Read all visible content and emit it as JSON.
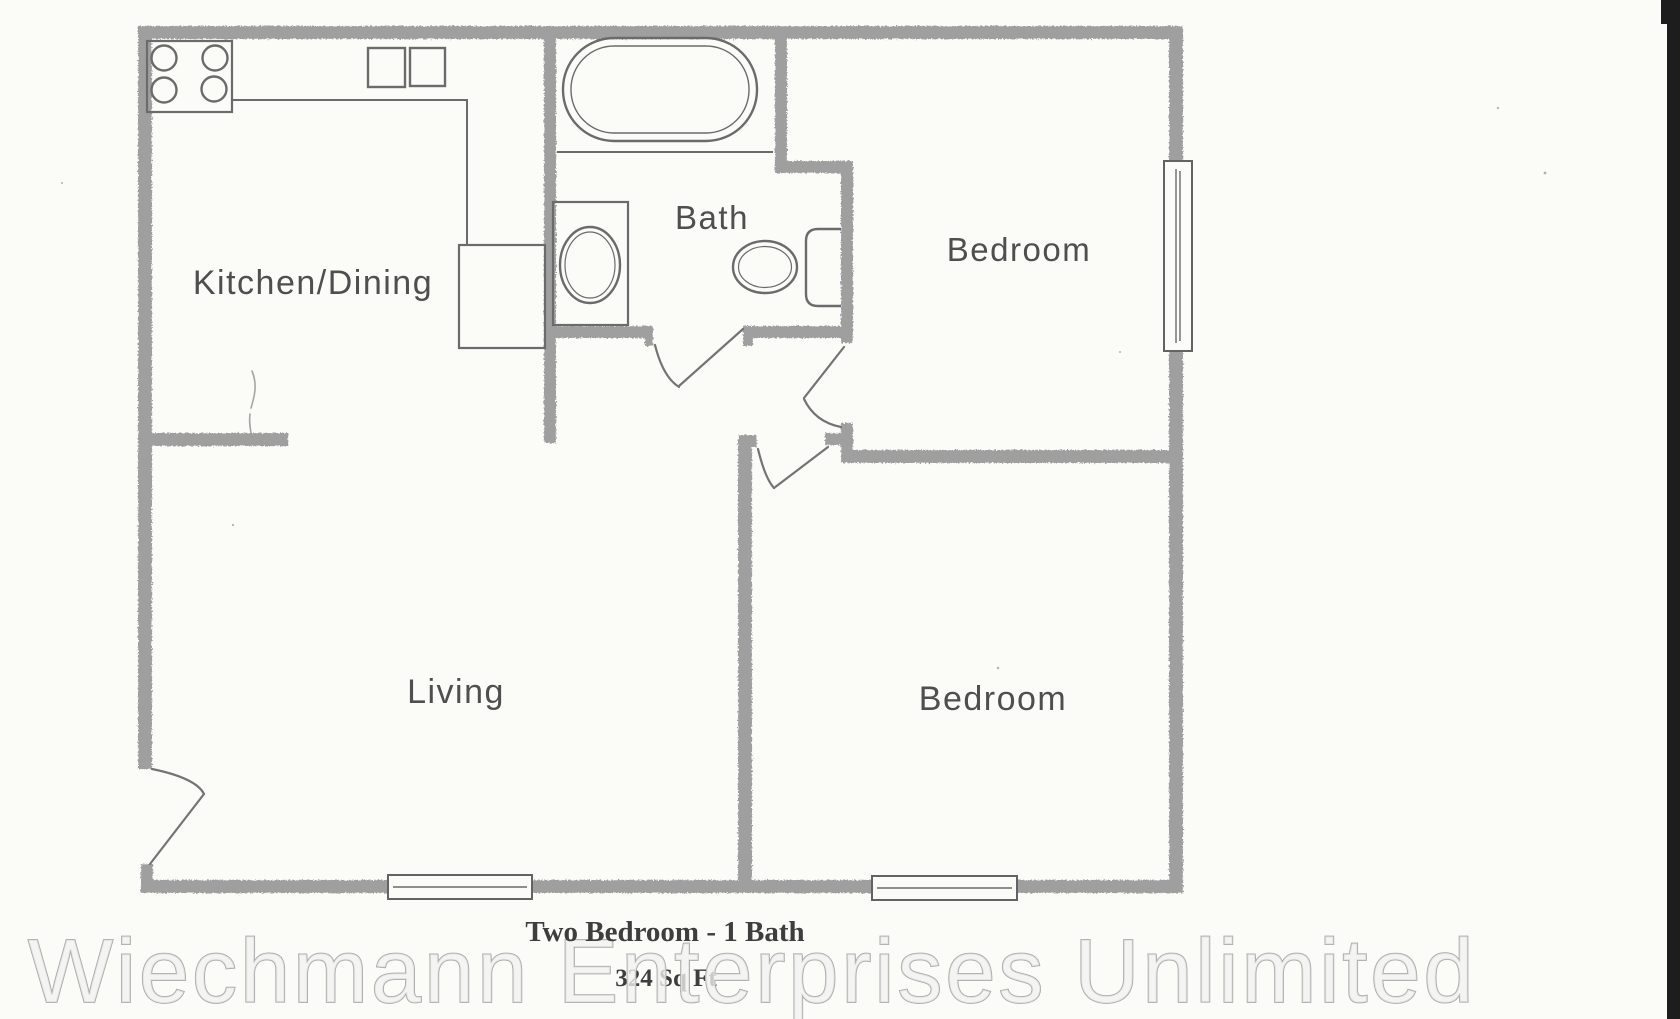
{
  "page": {
    "background": "#fbfbf8",
    "scan_edge_color": "#1d1d1d"
  },
  "colors": {
    "wall": "#9f9f9f",
    "fixture_line": "#6b6b6b",
    "label": "#4f4f4f",
    "caption": "#3e3e3e",
    "watermark_fill": "#f2f2ef"
  },
  "rooms": {
    "kitchen": {
      "label": "Kitchen/Dining"
    },
    "bath": {
      "label": "Bath"
    },
    "bedroom_top": {
      "label": "Bedroom"
    },
    "bedroom_bottom": {
      "label": "Bedroom"
    },
    "living": {
      "label": "Living"
    }
  },
  "fixtures": [
    "stove-burners",
    "kitchen-cabinets",
    "kitchen-counter",
    "pantry-closet",
    "bathtub",
    "vanity-sink",
    "toilet",
    "door-swing",
    "window"
  ],
  "caption": {
    "title": "Two Bedroom - 1 Bath",
    "area": "324 Sq Ft"
  },
  "watermark": {
    "text": "Wiechmann Enterprises Unlimited"
  }
}
